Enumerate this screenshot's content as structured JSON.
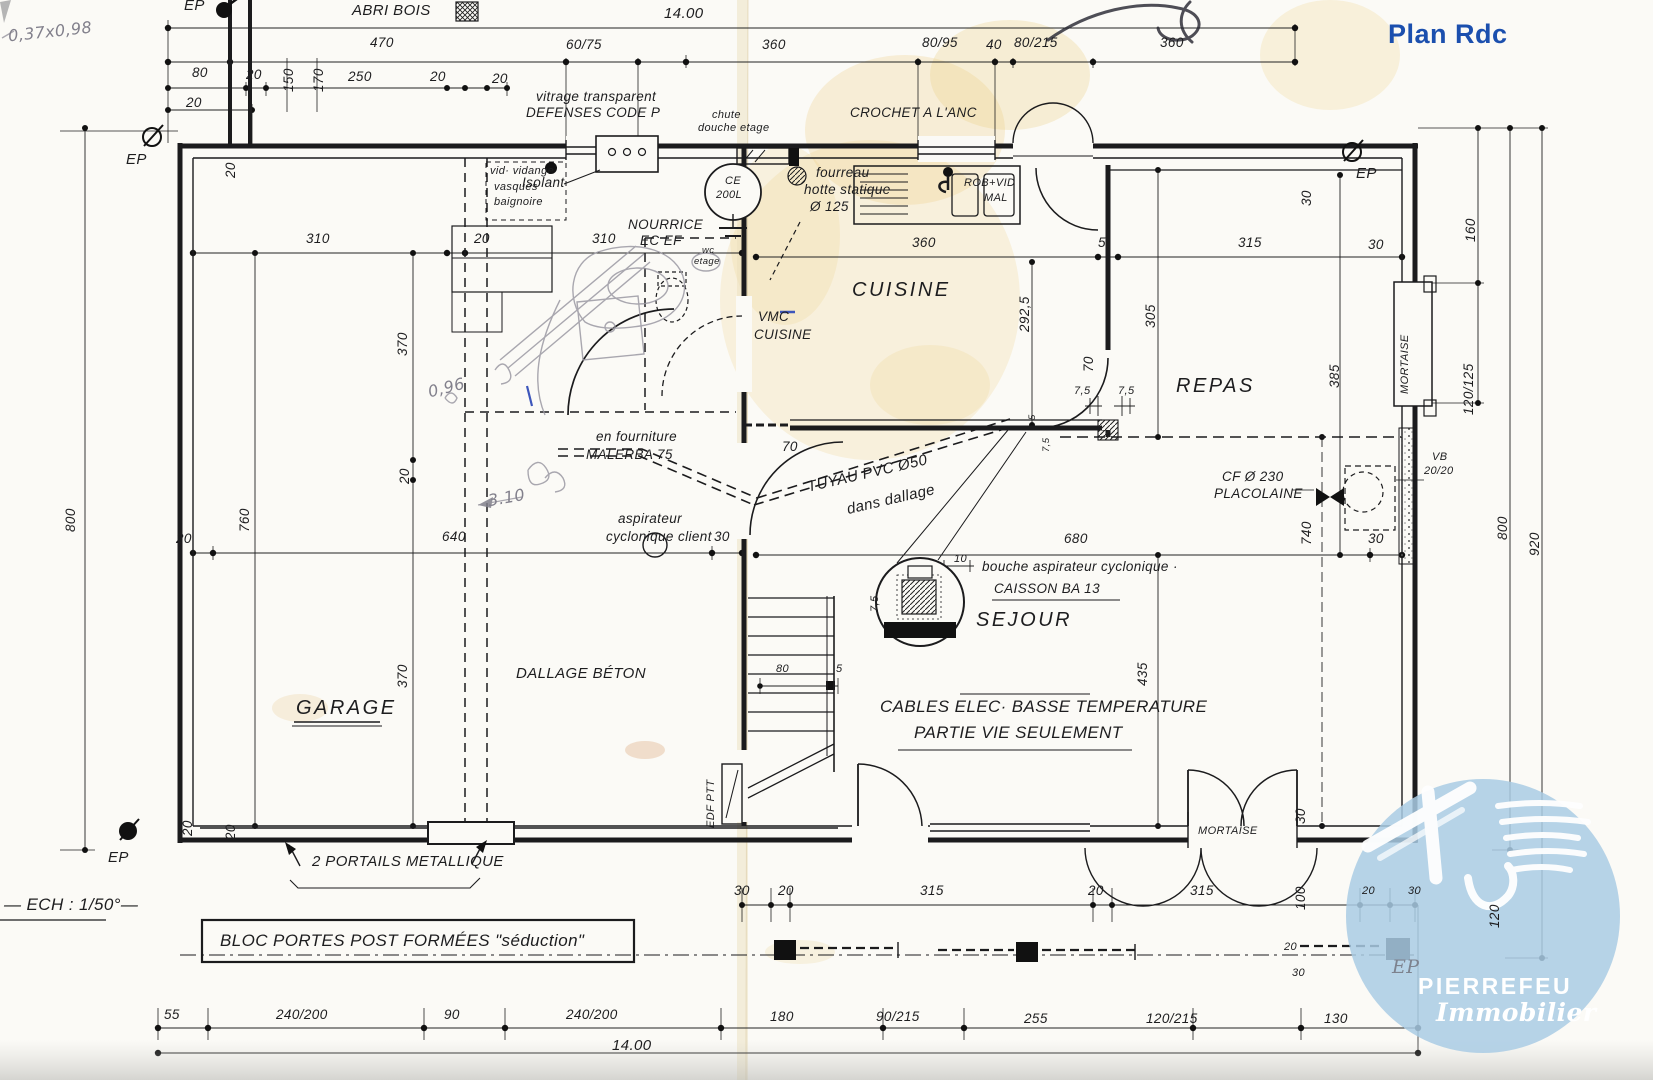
{
  "title": "Plan Rdc",
  "scale_note": "— ECH : 1/50°—",
  "handwritten": {
    "note": "0,37x0,98",
    "arrow_dim": "3.10",
    "small": "0,96"
  },
  "rooms": {
    "garage": "GARAGE",
    "cuisine": "CUISINE",
    "repas": "REPAS",
    "sejour": "SEJOUR"
  },
  "annotations": {
    "abri_bois": "ABRI BOIS",
    "vitrage": "vitrage transparent",
    "defenses": "DEFENSES CODE P",
    "chute_1": "chute",
    "chute_2": "douche etage",
    "crochet": "CROCHET A L'ANC",
    "vid_1": "vid· vidange",
    "vid_2": "vasques",
    "vid_3": "baignoire",
    "isolant": "Isolant",
    "ce_1": "CE",
    "ce_2": "200L",
    "nourrice_1": "NOURRICE",
    "nourrice_2": "EC EF",
    "wc_1": "wc",
    "wc_2": "etage",
    "fourreau_1": "fourreau",
    "fourreau_2": "hotte statique",
    "fourreau_3": "Ø 125",
    "rob_1": "ROB+VID",
    "rob_2": "MAL",
    "vmc_1": "VMC",
    "vmc_2": "CUISINE",
    "malerba_1": "en fourniture",
    "malerba_2": "MALERBA 75",
    "aspirateur_1": "aspirateur",
    "aspirateur_2": "cyclonique client",
    "tuyau_1": "TUYAU PVC Ø50",
    "tuyau_2": "dans dallage",
    "bouche": "bouche aspirateur cyclonique ·",
    "caisson": "CAISSON BA 13",
    "cf_1": "CF Ø 230",
    "cf_2": "PLACOLAINE",
    "vb_1": "VB",
    "vb_2": "20/20",
    "mortaise_right": "MORTAISE",
    "mortaise_bottom": "MORTAISE",
    "dallage": "DALLAGE BÉTON",
    "cables_1": "CABLES ELEC· BASSE TEMPERATURE",
    "cables_2": "PARTIE VIE SEULEMENT",
    "edf": "EDF PTT",
    "portails": "2  PORTAILS  METALLIQUE",
    "bloc": "BLOC  PORTES  POST  FORMÉES  \"séduction\"",
    "ep": "EP"
  },
  "dims": {
    "top14": "14.00",
    "bot14": "14.00",
    "t470": "470",
    "t6075": "60/75",
    "t360a": "360",
    "t8095": "80/95",
    "t40": "40",
    "t80215": "80/215",
    "t360b": "360",
    "t80": "80",
    "t20a": "20",
    "t150": "150",
    "t170": "170",
    "t250": "250",
    "t20b": "20",
    "t20c": "20",
    "t20d": "20",
    "t20e": "20",
    "l800": "800",
    "l760": "760",
    "l370a": "370",
    "l20mid": "20",
    "l370b": "370",
    "l20a": "20",
    "l20b": "20",
    "r310a": "310",
    "r20": "20",
    "r310b": "310",
    "k360": "360",
    "k5": "5",
    "k315": "315",
    "k30": "30",
    "k2925": "292,5",
    "k305": "305",
    "k30top": "30",
    "k385": "385",
    "k70": "70",
    "k75a": "7,5",
    "k75b": "7,5",
    "k5b": "5",
    "k75c": "7,5",
    "m20": "20",
    "m640": "640",
    "m30": "30",
    "m680": "680",
    "m30b": "30",
    "m10": "10",
    "m75": "7,5",
    "m70": "70",
    "s80": "80",
    "s5": "5",
    "v435": "435",
    "rc160": "160",
    "rc120125": "120/125",
    "rc800": "800",
    "rc920": "920",
    "rc120": "120",
    "rc740": "740",
    "d30": "30",
    "d100": "100",
    "b30": "30",
    "b20a": "20",
    "b315a": "315",
    "b20b": "20",
    "b315b": "315",
    "b20c": "20",
    "b30c": "30",
    "b20d": "20",
    "b30d": "30",
    "f55": "55",
    "f240a": "240/200",
    "f90": "90",
    "f240b": "240/200",
    "f180": "180",
    "f90215": "90/215",
    "f255": "255",
    "f120215": "120/215",
    "f130": "130"
  },
  "logo": {
    "name": "PIERREFEU",
    "tagline": "Immobilier",
    "circle_color": "#a9cbe4",
    "text_color": "#ffffff"
  },
  "colors": {
    "title_blue": "#1b4fae",
    "ink": "#1d1d1f",
    "pencil": "#8f8d98",
    "stain": "#eccf85",
    "paper": "#fbfaf6"
  }
}
